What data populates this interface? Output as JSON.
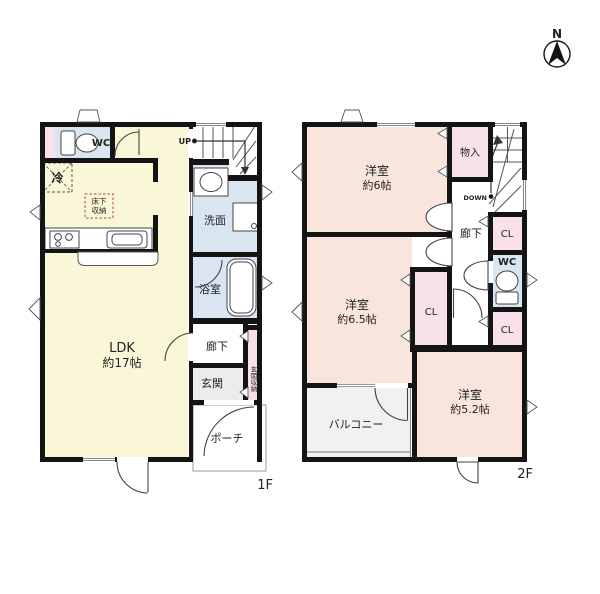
{
  "compass": {
    "label": "N"
  },
  "colors": {
    "wall": "#141414",
    "ldk_yellow": "#FAF7D8",
    "room_peach": "#FAE5DC",
    "closet_pink": "#F8E1EA",
    "wet_blue": "#D9E6F2",
    "entry_gray": "#ECECEC",
    "balcony_gray": "#F1F1F1",
    "storage_red": "#A64A4A"
  },
  "floor1": {
    "label": "1F",
    "wc": "WC",
    "ldk": "LDK",
    "ldk_size": "約17帖",
    "washroom": "洗面",
    "bathroom": "浴室",
    "hallway": "廊下",
    "entrance": "玄関",
    "entrance_storage": "玄関収納",
    "porch": "ポーチ",
    "underfloor_1": "床下",
    "underfloor_2": "収納",
    "fridge": "冷",
    "up": "UP"
  },
  "floor2": {
    "label": "2F",
    "room6": "洋室",
    "room6_size": "約6帖",
    "storage": "物入",
    "down": "DOWN",
    "hallway": "廊下",
    "cl_top": "CL",
    "wc": "WC",
    "cl_mid": "CL",
    "cl_bottom": "CL",
    "room65": "洋室",
    "room65_size": "約6.5帖",
    "room52": "洋室",
    "room52_size": "約5.2帖",
    "balcony": "バルコニー"
  }
}
